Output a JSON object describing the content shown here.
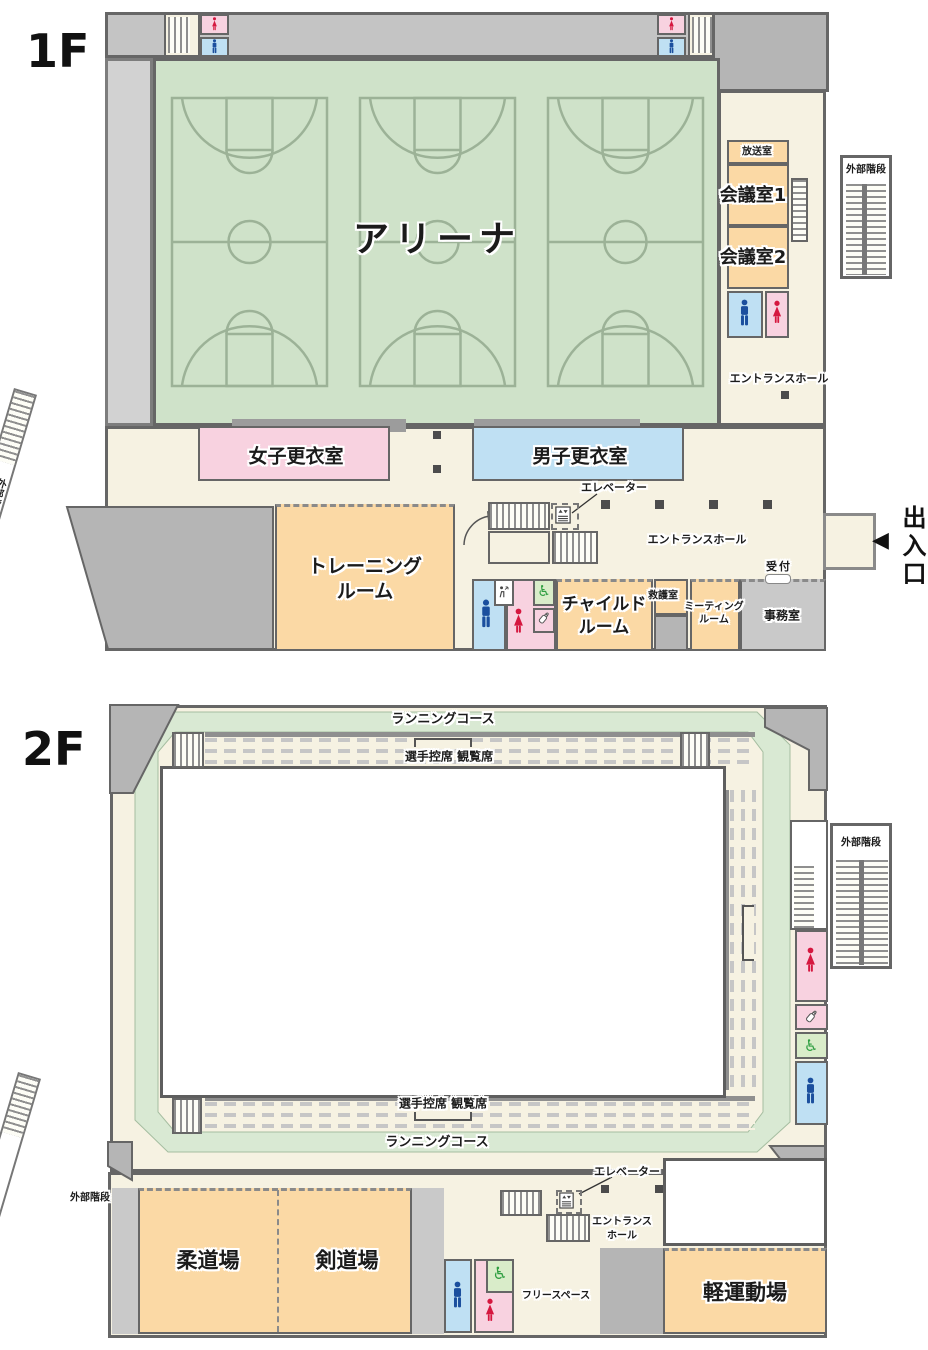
{
  "palette": {
    "arena_green": "#cfe2c9",
    "track_green": "#d9e9d3",
    "cream": "#f6f2e2",
    "orange": "#fbd9a5",
    "pink": "#f8d2e0",
    "blue": "#bfe0f3",
    "accessible_green": "#d9ecc9",
    "building_gray": "#b5b5b5",
    "wall": "#666666",
    "male_blue": "#1b4f9e",
    "female_red": "#d5173f",
    "wheelchair_green": "#2f9e41"
  },
  "icons": {
    "wheelchair": "♿",
    "entrance_arrow": "◀"
  },
  "f1": {
    "floor": "1F",
    "arena": "アリーナ",
    "broadcast": "放送室",
    "meeting1": "会議室1",
    "meeting2": "会議室2",
    "entrance_hall": "エントランスホール",
    "women_locker": "女子更衣室",
    "men_locker": "男子更衣室",
    "training_1": "トレーニング",
    "room_word": "ルーム",
    "child_1": "チャイルド",
    "first_aid": "救護室",
    "meeting_sm_1": "ミーティング",
    "office": "事務室",
    "reception": "受付",
    "exit": "出入口",
    "elevator": "エレベーター",
    "ext_stairs": "外部階段"
  },
  "f2": {
    "floor": "2F",
    "run_course": "ランニングコース",
    "seats": "選手控席 観覧席",
    "ext_stairs": "外部階段",
    "judo": "柔道場",
    "kendo": "剣道場",
    "free_space": "フリースペース",
    "light_gym": "軽運動場",
    "elevator": "エレベーター",
    "hall_1": "エントランス",
    "hall_2": "ホール"
  }
}
